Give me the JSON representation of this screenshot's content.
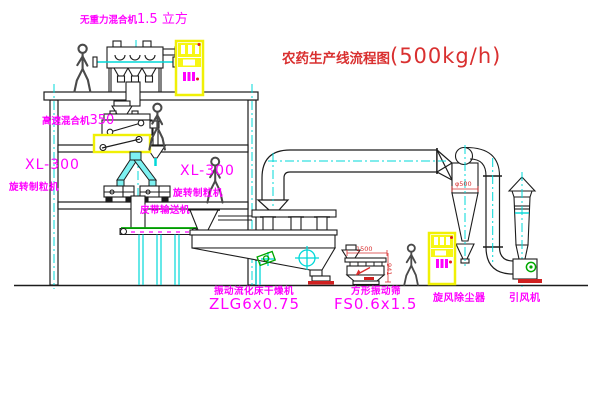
{
  "title": {
    "name": "农药生产线流程图",
    "capacity": "(500kg/h)"
  },
  "equipment_labels": {
    "gravity_mixer": {
      "name": "无重力混合机",
      "spec": "1.5 立方"
    },
    "high_speed_mixer": {
      "name": "高速混合机",
      "spec": "350"
    },
    "granulator_left": {
      "model": "XL-300",
      "name": "旋转制粒机"
    },
    "granulator_right": {
      "model": "XL-300",
      "name": "旋转制粒机"
    },
    "belt_conveyor": {
      "name": "皮带输送机"
    },
    "fluid_bed_dryer": {
      "name": "振动流化床干燥机",
      "model": "ZLG6x0.75"
    },
    "vibrating_screen": {
      "name": "方形振动筛",
      "model": "FS0.6x1.5"
    },
    "cyclone": {
      "name": "旋风除尘器"
    },
    "induced_draft_fan": {
      "name": "引风机"
    }
  },
  "dimensions": {
    "cyclone_diameter": "φ500",
    "screen_length": "1500",
    "screen_height": "941"
  },
  "colors": {
    "line": "#1c1c1c",
    "centerline_cyan": "#00d8d8",
    "label_magenta": "#ff00ff",
    "title_red": "#d93030",
    "cabinet_yellow": "#f0f005",
    "belt_green": "#00a800",
    "base_red": "#d02020"
  }
}
